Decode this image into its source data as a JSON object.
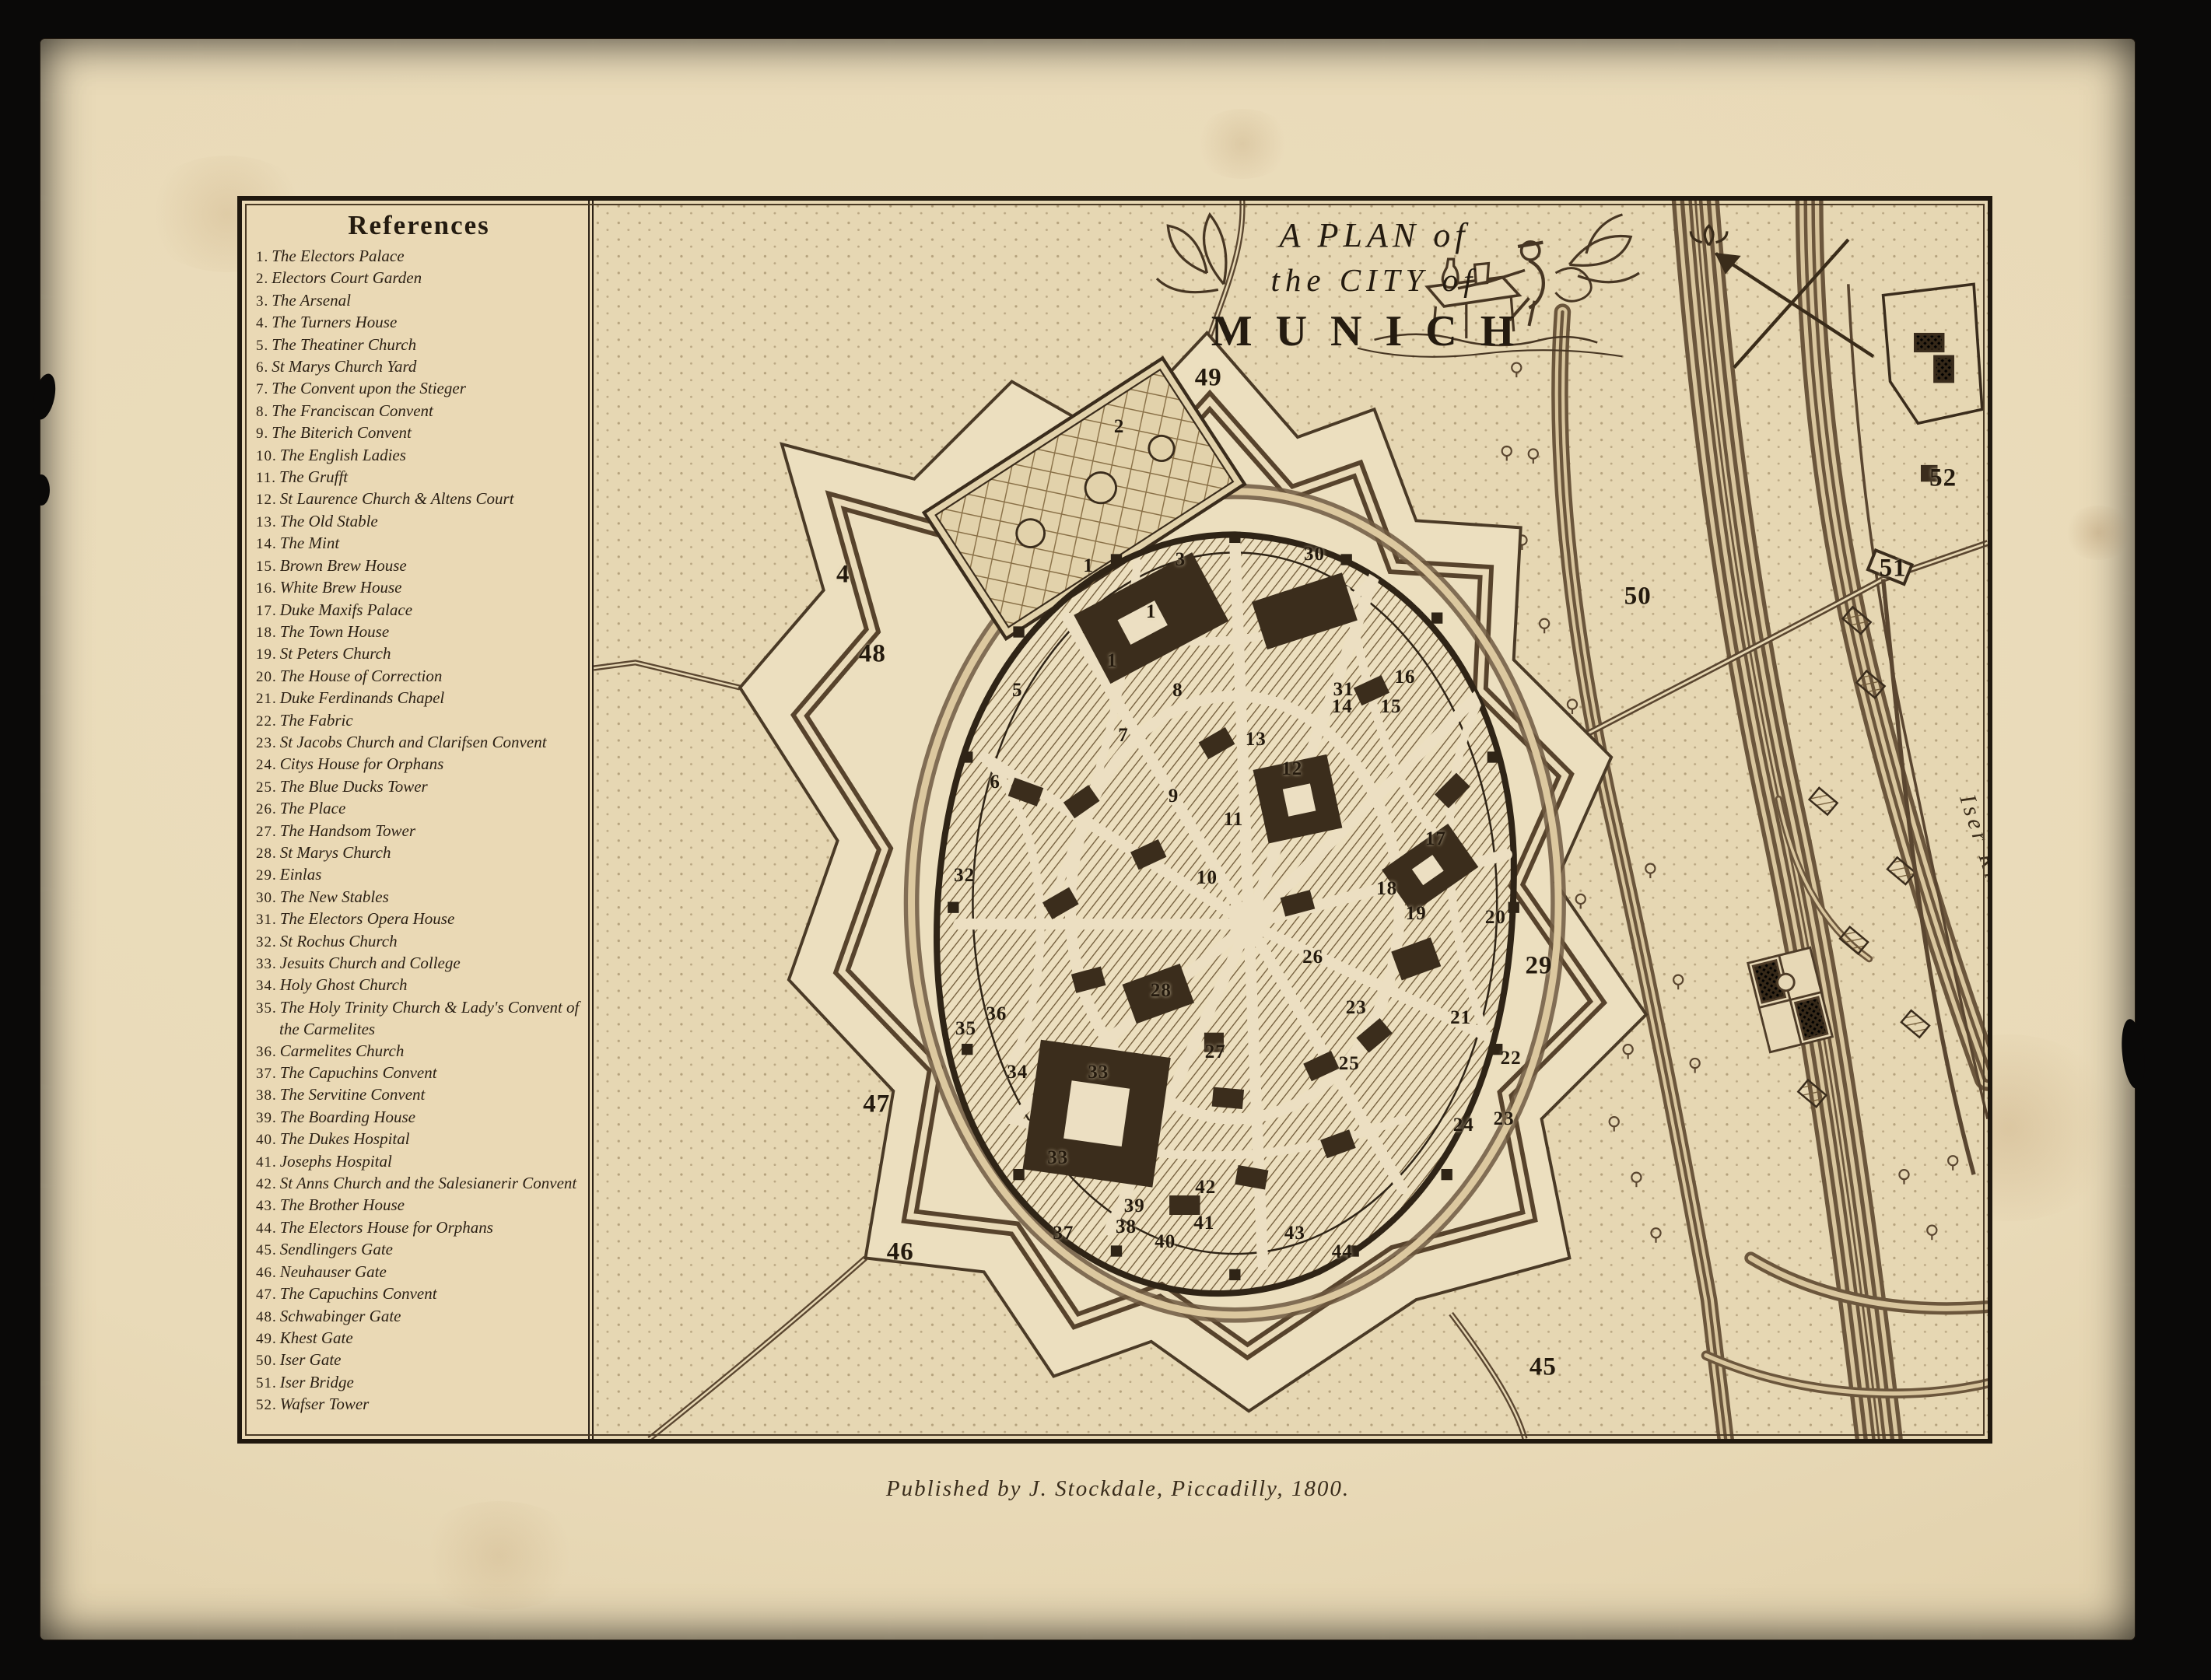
{
  "plate": {
    "title_line1": "A PLAN of",
    "title_line2": "the CITY of",
    "title_line3": "MUNICH",
    "publication": "Published by J. Stockdale, Piccadilly, 1800.",
    "river_label": "Iser River"
  },
  "references": {
    "heading": "References",
    "items": [
      {
        "n": "1",
        "label": "The Electors Palace"
      },
      {
        "n": "2",
        "label": "Electors Court Garden"
      },
      {
        "n": "3",
        "label": "The Arsenal"
      },
      {
        "n": "4",
        "label": "The Turners House"
      },
      {
        "n": "5",
        "label": "The Theatiner Church"
      },
      {
        "n": "6",
        "label": "St Marys Church Yard"
      },
      {
        "n": "7",
        "label": "The Convent upon the Stieger"
      },
      {
        "n": "8",
        "label": "The Franciscan Convent"
      },
      {
        "n": "9",
        "label": "The Biterich Convent"
      },
      {
        "n": "10",
        "label": "The English Ladies"
      },
      {
        "n": "11",
        "label": "The Grufft"
      },
      {
        "n": "12",
        "label": "St Laurence Church & Altens Court"
      },
      {
        "n": "13",
        "label": "The Old Stable"
      },
      {
        "n": "14",
        "label": "The Mint"
      },
      {
        "n": "15",
        "label": "Brown Brew House"
      },
      {
        "n": "16",
        "label": "White Brew House"
      },
      {
        "n": "17",
        "label": "Duke Maxifs Palace"
      },
      {
        "n": "18",
        "label": "The Town House"
      },
      {
        "n": "19",
        "label": "St Peters Church"
      },
      {
        "n": "20",
        "label": "The House of Correction"
      },
      {
        "n": "21",
        "label": "Duke Ferdinands Chapel"
      },
      {
        "n": "22",
        "label": "The Fabric"
      },
      {
        "n": "23",
        "label": "St Jacobs Church and Clarifsen Convent"
      },
      {
        "n": "24",
        "label": "Citys House for Orphans"
      },
      {
        "n": "25",
        "label": "The Blue Ducks Tower"
      },
      {
        "n": "26",
        "label": "The Place"
      },
      {
        "n": "27",
        "label": "The Handsom Tower"
      },
      {
        "n": "28",
        "label": "St Marys Church"
      },
      {
        "n": "29",
        "label": "Einlas"
      },
      {
        "n": "30",
        "label": "The New Stables"
      },
      {
        "n": "31",
        "label": "The Electors Opera House"
      },
      {
        "n": "32",
        "label": "St Rochus Church"
      },
      {
        "n": "33",
        "label": "Jesuits Church and College"
      },
      {
        "n": "34",
        "label": "Holy Ghost Church"
      },
      {
        "n": "35",
        "label": "The Holy Trinity Church & Lady's Convent of the Carmelites"
      },
      {
        "n": "36",
        "label": "Carmelites Church"
      },
      {
        "n": "37",
        "label": "The Capuchins Convent"
      },
      {
        "n": "38",
        "label": "The Servitine Convent"
      },
      {
        "n": "39",
        "label": "The Boarding House"
      },
      {
        "n": "40",
        "label": "The Dukes Hospital"
      },
      {
        "n": "41",
        "label": "Josephs Hospital"
      },
      {
        "n": "42",
        "label": "St Anns Church and the Salesianerir Convent"
      },
      {
        "n": "43",
        "label": "The Brother House"
      },
      {
        "n": "44",
        "label": "The Electors House for Orphans"
      },
      {
        "n": "45",
        "label": "Sendlingers Gate"
      },
      {
        "n": "46",
        "label": "Neuhauser Gate"
      },
      {
        "n": "47",
        "label": "The Capuchins Convent"
      },
      {
        "n": "48",
        "label": "Schwabinger Gate"
      },
      {
        "n": "49",
        "label": "Khest Gate"
      },
      {
        "n": "50",
        "label": "Iser Gate"
      },
      {
        "n": "51",
        "label": "Iser Bridge"
      },
      {
        "n": "52",
        "label": "Wafser Tower"
      }
    ]
  },
  "markers": [
    {
      "n": "1",
      "x": 35.5,
      "y": 29.5
    },
    {
      "n": "1",
      "x": 40.0,
      "y": 33.2
    },
    {
      "n": "1",
      "x": 37.2,
      "y": 37.2
    },
    {
      "n": "2",
      "x": 37.7,
      "y": 18.3
    },
    {
      "n": "3",
      "x": 42.1,
      "y": 29.0
    },
    {
      "n": "4",
      "x": 17.9,
      "y": 30.2,
      "s": "lg"
    },
    {
      "n": "5",
      "x": 30.4,
      "y": 39.6
    },
    {
      "n": "6",
      "x": 28.8,
      "y": 47.0
    },
    {
      "n": "7",
      "x": 38.0,
      "y": 43.2
    },
    {
      "n": "8",
      "x": 41.9,
      "y": 39.6
    },
    {
      "n": "9",
      "x": 41.6,
      "y": 48.1
    },
    {
      "n": "10",
      "x": 44.0,
      "y": 54.7
    },
    {
      "n": "11",
      "x": 45.9,
      "y": 50.0
    },
    {
      "n": "12",
      "x": 50.1,
      "y": 45.9
    },
    {
      "n": "13",
      "x": 47.5,
      "y": 43.5
    },
    {
      "n": "14",
      "x": 53.7,
      "y": 40.9
    },
    {
      "n": "15",
      "x": 57.2,
      "y": 40.9
    },
    {
      "n": "16",
      "x": 58.2,
      "y": 38.5
    },
    {
      "n": "17",
      "x": 60.4,
      "y": 51.6
    },
    {
      "n": "18",
      "x": 56.9,
      "y": 55.6
    },
    {
      "n": "19",
      "x": 59.0,
      "y": 57.6
    },
    {
      "n": "20",
      "x": 64.7,
      "y": 57.9
    },
    {
      "n": "21",
      "x": 62.2,
      "y": 66.0
    },
    {
      "n": "22",
      "x": 65.8,
      "y": 69.3
    },
    {
      "n": "23",
      "x": 54.7,
      "y": 65.2
    },
    {
      "n": "23",
      "x": 65.3,
      "y": 74.2
    },
    {
      "n": "24",
      "x": 62.4,
      "y": 74.7
    },
    {
      "n": "25",
      "x": 54.2,
      "y": 69.7
    },
    {
      "n": "26",
      "x": 51.6,
      "y": 61.1
    },
    {
      "n": "27",
      "x": 44.6,
      "y": 68.8
    },
    {
      "n": "28",
      "x": 40.7,
      "y": 63.8
    },
    {
      "n": "29",
      "x": 67.8,
      "y": 61.8,
      "s": "lg"
    },
    {
      "n": "30",
      "x": 51.7,
      "y": 28.6
    },
    {
      "n": "31",
      "x": 53.8,
      "y": 39.5
    },
    {
      "n": "32",
      "x": 26.6,
      "y": 54.5
    },
    {
      "n": "33",
      "x": 36.2,
      "y": 70.4
    },
    {
      "n": "33",
      "x": 33.3,
      "y": 77.3
    },
    {
      "n": "34",
      "x": 30.4,
      "y": 70.4
    },
    {
      "n": "35",
      "x": 26.7,
      "y": 66.9
    },
    {
      "n": "36",
      "x": 28.9,
      "y": 65.7
    },
    {
      "n": "37",
      "x": 33.7,
      "y": 83.4
    },
    {
      "n": "38",
      "x": 38.2,
      "y": 82.9
    },
    {
      "n": "39",
      "x": 38.8,
      "y": 81.2
    },
    {
      "n": "40",
      "x": 41.0,
      "y": 84.1
    },
    {
      "n": "41",
      "x": 43.8,
      "y": 82.6
    },
    {
      "n": "42",
      "x": 43.9,
      "y": 79.7
    },
    {
      "n": "43",
      "x": 50.3,
      "y": 83.4
    },
    {
      "n": "44",
      "x": 53.7,
      "y": 84.9
    },
    {
      "n": "45",
      "x": 68.1,
      "y": 94.2,
      "s": "lg"
    },
    {
      "n": "46",
      "x": 22.0,
      "y": 84.9,
      "s": "lg"
    },
    {
      "n": "47",
      "x": 20.3,
      "y": 73.0,
      "s": "lg"
    },
    {
      "n": "48",
      "x": 20.0,
      "y": 36.6,
      "s": "lg"
    },
    {
      "n": "49",
      "x": 44.1,
      "y": 14.3,
      "s": "lg"
    },
    {
      "n": "50",
      "x": 74.9,
      "y": 32.0,
      "s": "lg"
    },
    {
      "n": "51",
      "x": 93.2,
      "y": 29.7,
      "s": "lg"
    },
    {
      "n": "52",
      "x": 96.8,
      "y": 22.4,
      "s": "lg"
    }
  ]
}
